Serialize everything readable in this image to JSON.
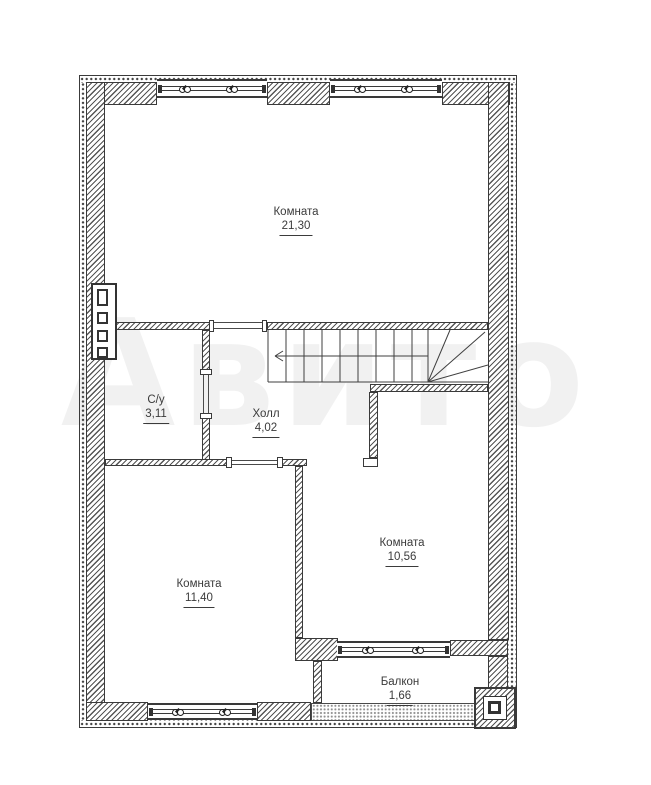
{
  "watermark": {
    "text": "Авито",
    "opacity": 0.05
  },
  "plan": {
    "type": "floor-plan",
    "rooms": [
      {
        "id": "room-top",
        "name": "Комната",
        "area": "21,30"
      },
      {
        "id": "bathroom",
        "name": "С/у",
        "area": "3,11"
      },
      {
        "id": "hall",
        "name": "Холл",
        "area": "4,02"
      },
      {
        "id": "room-left",
        "name": "Комната",
        "area": "11,40"
      },
      {
        "id": "room-right",
        "name": "Комната",
        "area": "10,56"
      },
      {
        "id": "balcony",
        "name": "Балкон",
        "area": "1,66"
      }
    ],
    "icons": [
      "window-vent-icon",
      "stairs-direction-arrow",
      "flue-shaft",
      "column-marker"
    ],
    "colors": {
      "wall_line": "#3a3a3a",
      "hatch": "#555555",
      "label_text": "#3b3b3b",
      "background": "#ffffff"
    }
  }
}
